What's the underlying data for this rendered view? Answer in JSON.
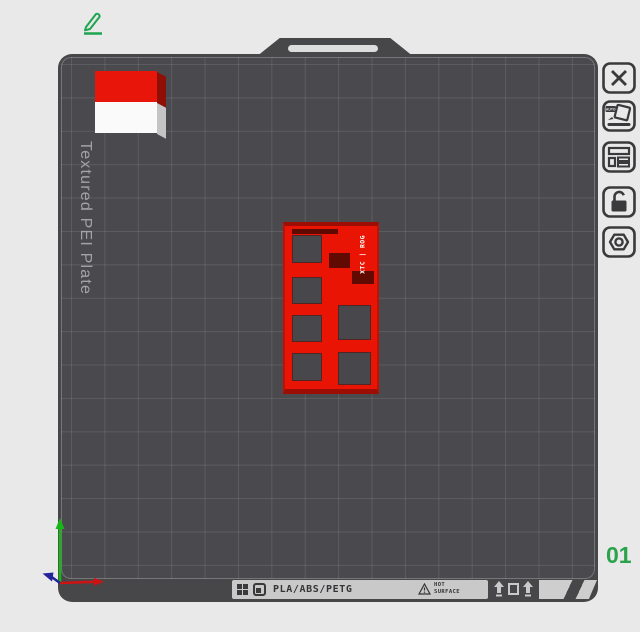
{
  "plate": {
    "name_label": "Textured PEI Plate",
    "number_label": "01",
    "surface_color": "#47474a",
    "grid_line_color": "rgba(255,255,255,0.10)"
  },
  "toolbar": {
    "auto_badge": "AUTO",
    "items": [
      "close",
      "auto-orient",
      "plate-settings",
      "lock-unlocked",
      "nut-settings"
    ]
  },
  "bottom_bar": {
    "materials": "PLA/ABS/PETG",
    "warning_line1": "HOT",
    "warning_line2": "SURFACE"
  },
  "model": {
    "badge": "XTC | ROG",
    "color": "#ea1404"
  },
  "colors": {
    "accent_green": "#2ba24c",
    "axis_x": "#cf1212",
    "axis_y": "#17b517",
    "axis_z": "#23239a",
    "cube_red": "#e8150a",
    "cube_white": "#fafafa"
  }
}
